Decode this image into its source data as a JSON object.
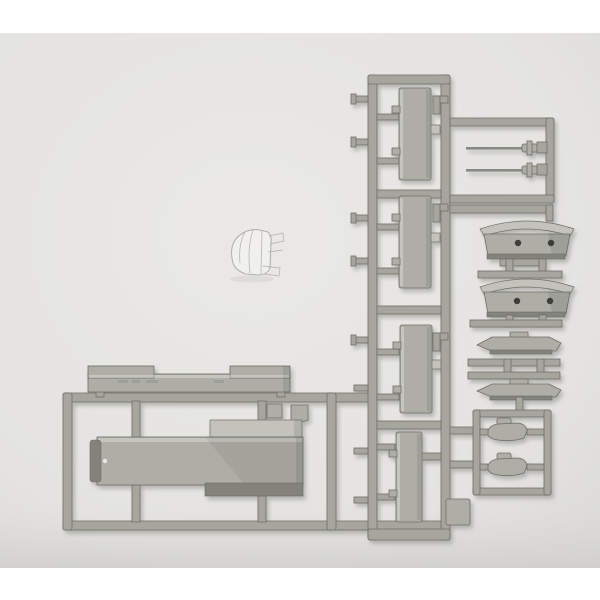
{
  "scene": {
    "description": "Photograph of a gray plastic model kit parts sprue (runner) with long rectangular hull and deck parts, two small ship's-boat parts with locating holes, two thin mast/barrel parts, small fittings in sub-frames, and a separate small clear transparent canopy part, on a plain light-gray background",
    "parts": [
      {
        "name": "deck-part",
        "count": 1
      },
      {
        "name": "large-hull-part",
        "count": 1
      },
      {
        "name": "tall-rectangular-part",
        "count": 4
      },
      {
        "name": "ships-boat-with-holes",
        "count": 2
      },
      {
        "name": "thin-boat-part",
        "count": 2
      },
      {
        "name": "needle-mast-part",
        "count": 2
      },
      {
        "name": "small-fitting-part",
        "count": 3
      },
      {
        "name": "clear-canopy-part",
        "count": 1
      }
    ]
  },
  "colors": {
    "page_bg": "#ffffff",
    "photo_bg": "#eae9e6",
    "photo_bg_edge": "#d9d8d5",
    "plastic_mid": "#a6a69f",
    "plastic_part": "#aeaea7",
    "plastic_light": "#c3c3bc",
    "plastic_dark": "#83837c",
    "plastic_deep": "#6e6e68",
    "hole": "#3e3e3b",
    "clear_stroke": "#b3b3ad",
    "shadow": "#8f8e8a"
  }
}
